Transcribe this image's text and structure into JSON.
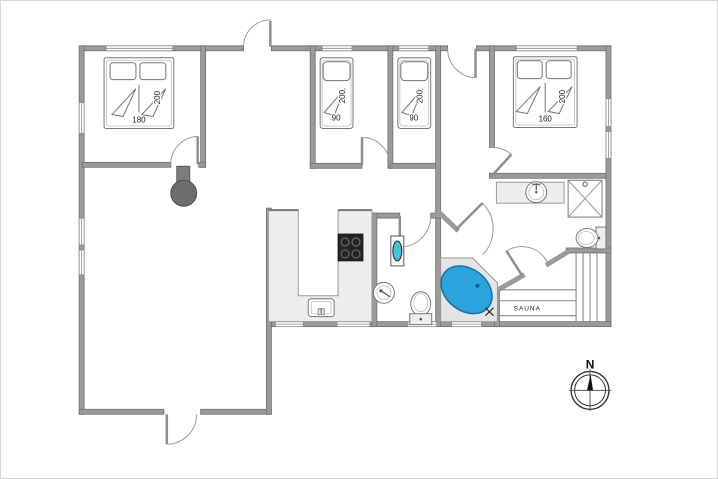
{
  "plan": {
    "bedrooms": [
      {
        "id": "bedroom-1",
        "bed_width": "180",
        "bed_length": "200"
      },
      {
        "id": "bedroom-2",
        "bed_width": "90",
        "bed_length": "200"
      },
      {
        "id": "bedroom-3",
        "bed_width": "90",
        "bed_length": "200"
      },
      {
        "id": "bedroom-4",
        "bed_width": "160",
        "bed_length": "200"
      }
    ],
    "sauna_label": "SAUNA",
    "compass_north_label": "N",
    "colors": {
      "wall": "#9a9a9a",
      "bathtub": "#2ba3dc",
      "bathtub_stroke": "#16729e",
      "boiler_accent": "#45c6d8",
      "stove": "#6e6e6e",
      "cooktop": "#242424",
      "counter": "#ededed"
    }
  }
}
